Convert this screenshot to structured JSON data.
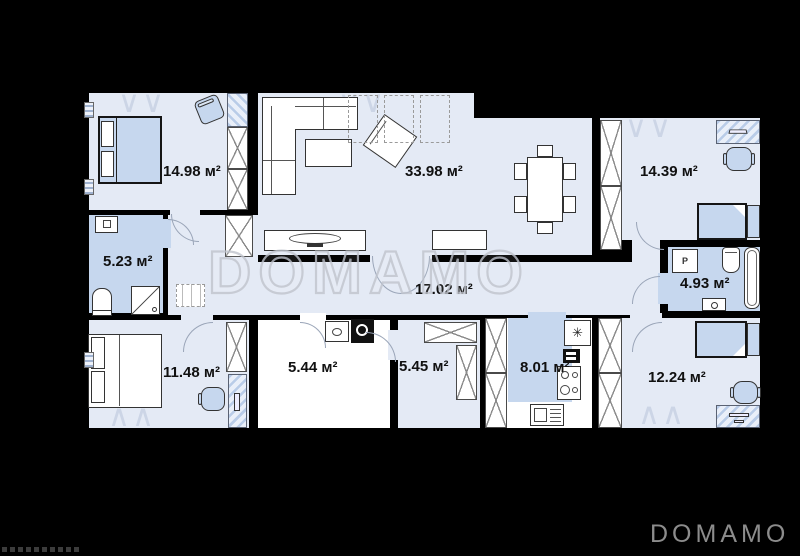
{
  "plan": {
    "watermark": "DOMAMO",
    "logo": "DOMAMO",
    "rooms": [
      {
        "name": "bedroom-top-left",
        "area": "14.98 м²"
      },
      {
        "name": "living-room",
        "area": "33.98 м²"
      },
      {
        "name": "bedroom-top-right",
        "area": "14.39 м²"
      },
      {
        "name": "bathroom-left",
        "area": "5.23 м²"
      },
      {
        "name": "hallway",
        "area": "17.02 м²"
      },
      {
        "name": "bathroom-right",
        "area": "4.93 м²"
      },
      {
        "name": "bedroom-bottom-left",
        "area": "11.48 м²"
      },
      {
        "name": "utility-room",
        "area": "5.44 м²"
      },
      {
        "name": "wardrobe-room",
        "area": "5.45 м²"
      },
      {
        "name": "kitchen",
        "area": "8.01 м²"
      },
      {
        "name": "bedroom-bottom-right",
        "area": "12.24 м²"
      }
    ],
    "icons": {
      "washer_label": "P",
      "fridge": "✳",
      "window_marks_down": "∨∨",
      "window_marks_up": "∧∧"
    },
    "colors": {
      "background": "#000000",
      "floor_light": "#e4eaf5",
      "floor_blue": "#c6d7ee",
      "wall": "#000000",
      "watermark_outline": "#c0c4cd",
      "logo_gray": "#8c8c8c"
    }
  }
}
